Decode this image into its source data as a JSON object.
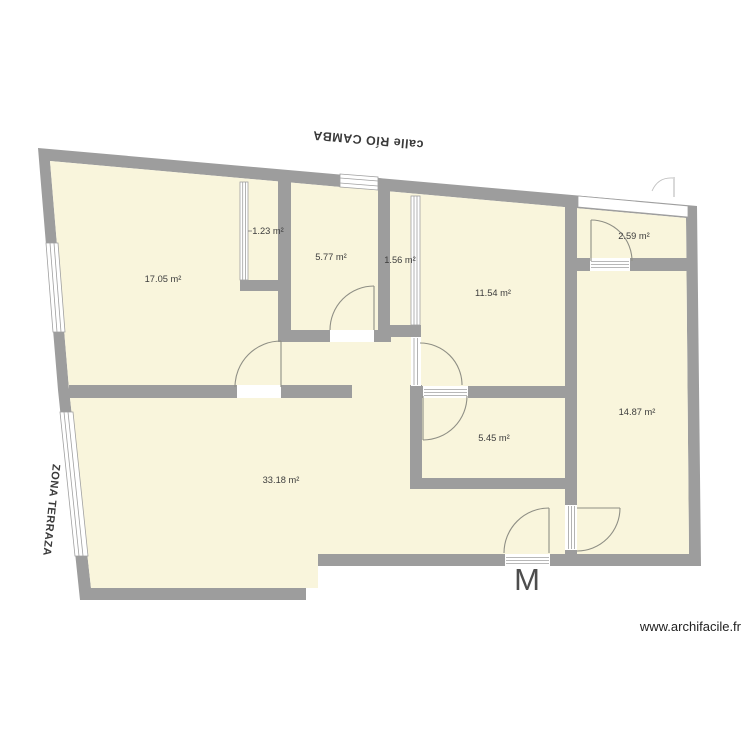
{
  "plan": {
    "street_label": "calle RÍO CAMBA",
    "terrace_label": "ZONA TERRAZA",
    "entrance_label": "M",
    "watermark": "www.archifacile.fr",
    "rooms": [
      {
        "name": "living-room",
        "area": "17.05 m²"
      },
      {
        "name": "closet",
        "area": "1.23 m²"
      },
      {
        "name": "bedroom-small",
        "area": "5.77 m²"
      },
      {
        "name": "corridor",
        "area": "1.56 m²"
      },
      {
        "name": "bedroom-mid",
        "area": "11.54 m²"
      },
      {
        "name": "storage",
        "area": "2.59 m²"
      },
      {
        "name": "bedroom-big",
        "area": "14.87 m²"
      },
      {
        "name": "bathroom",
        "area": "5.45 m²"
      },
      {
        "name": "main-room",
        "area": "33.18 m²"
      }
    ],
    "colors": {
      "wall": "#9d9d9d",
      "room_fill": "#f9f5dc",
      "door_line": "#8f8f85",
      "label_text": "#3d3d3d"
    }
  }
}
